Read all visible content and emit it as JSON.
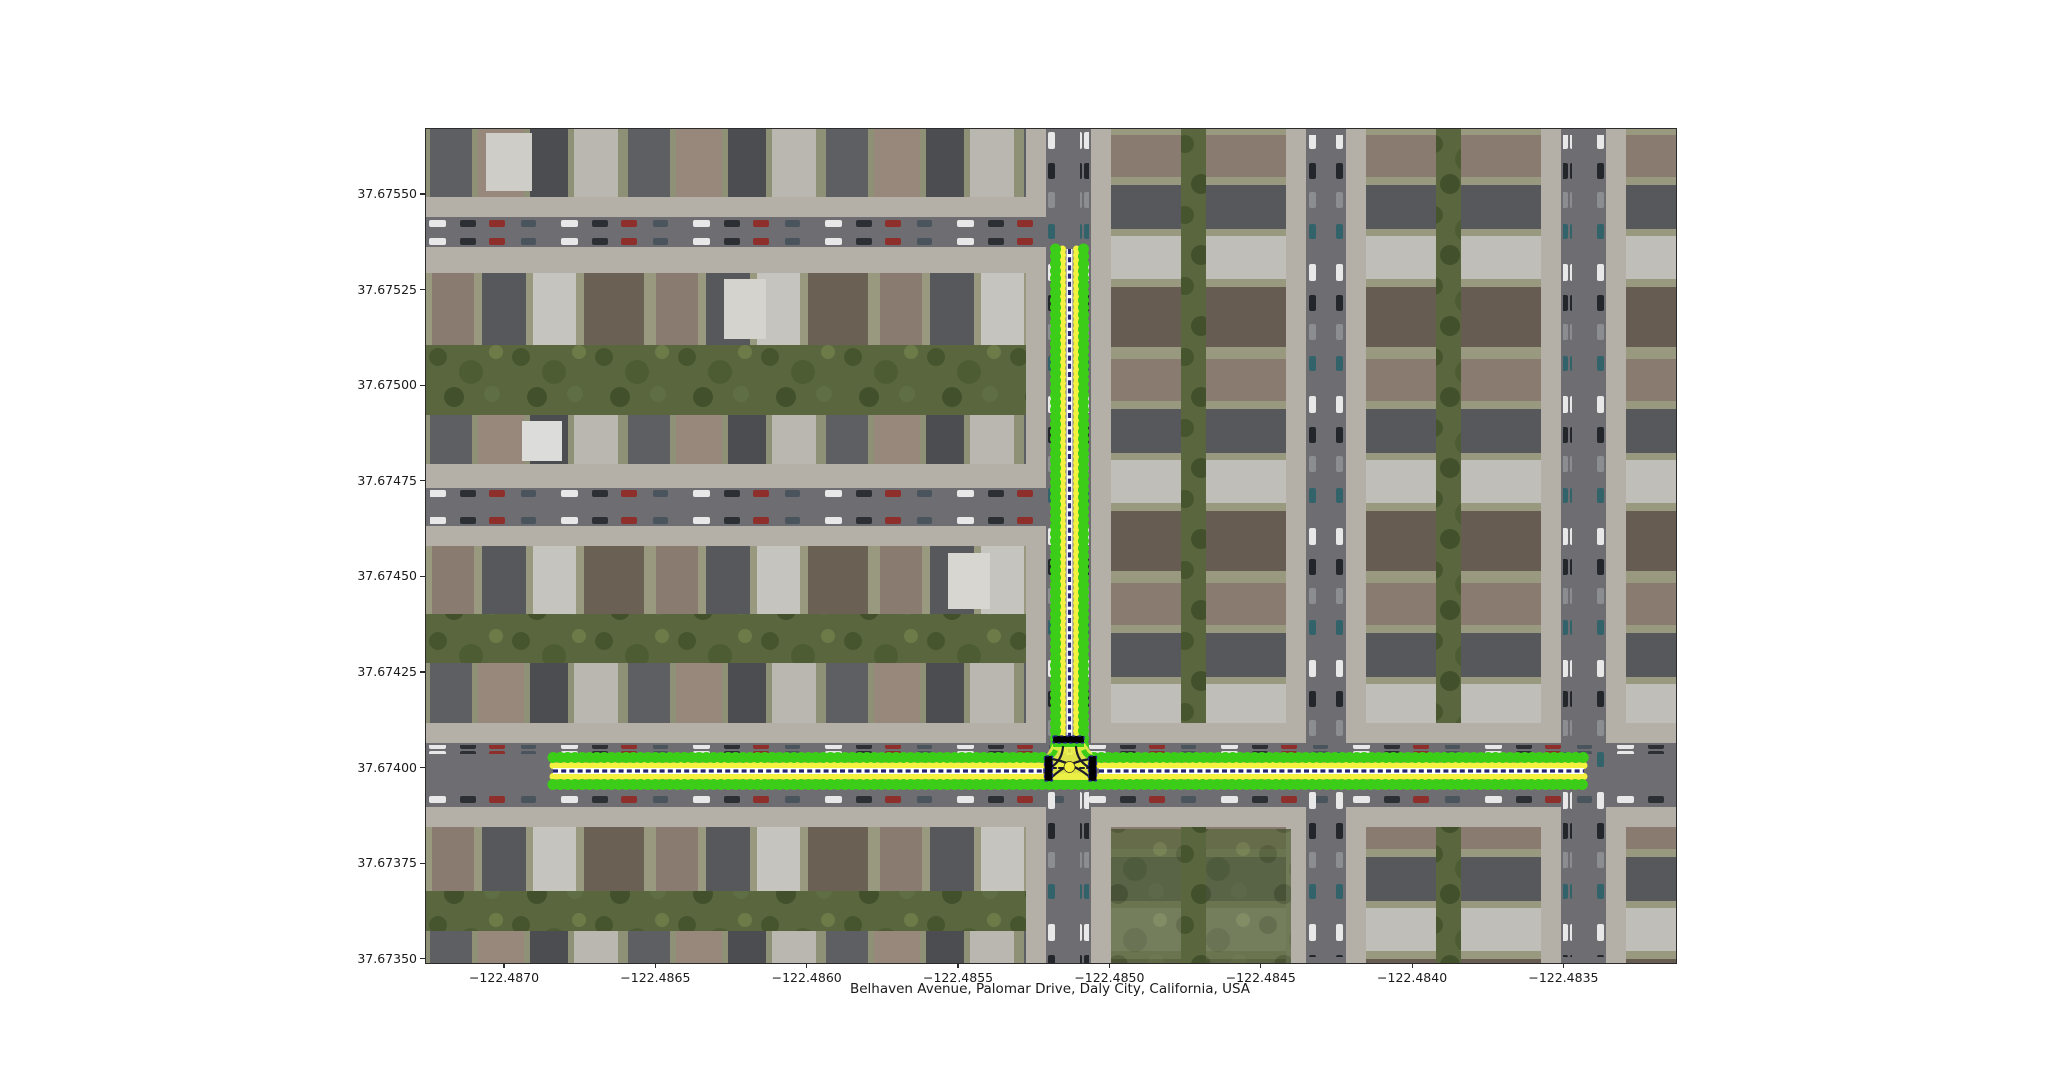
{
  "figure": {
    "title": "Belhaven Avenue, Palomar Drive, Daly City, California, USA"
  },
  "axes": {
    "y_ticks": [
      "37.67550",
      "37.67525",
      "37.67500",
      "37.67475",
      "37.67450",
      "37.67425",
      "37.67400",
      "37.67375",
      "37.67350"
    ],
    "x_ticks": [
      "−122.4870",
      "−122.4865",
      "−122.4860",
      "−122.4855",
      "−122.4850",
      "−122.4845",
      "−122.4840",
      "−122.4835"
    ]
  },
  "map": {
    "imagery": "satellite-aerial-residential-grid",
    "roads": [
      {
        "name": "Belhaven Avenue",
        "orientation": "horizontal"
      },
      {
        "name": "Palomar Drive",
        "orientation": "vertical"
      }
    ],
    "junction": "T-intersection with stop bars and crossing lane paths"
  },
  "colors": {
    "lane_boundary_green": "#3ccd19",
    "lane_fill_yellow": "#ebf046",
    "lane_dot_yellow": "#f4f23e",
    "centerline_white": "#ffffff",
    "centerline_blue": "#232370",
    "crosswalk_border_blue": "#2a2a96",
    "junction_path_dark": "#1c1c2a",
    "street_gray": "#6e6d71"
  }
}
